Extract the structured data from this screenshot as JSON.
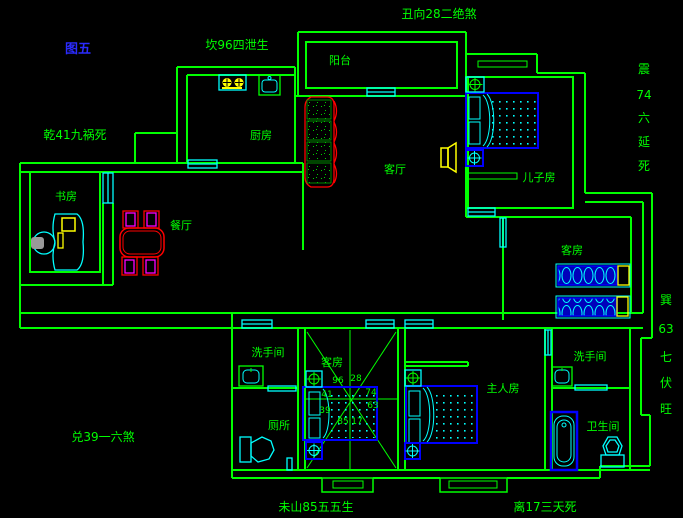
{
  "figure": {
    "tag": "图五"
  },
  "annotations": {
    "top": "丑向28二绝煞",
    "kan": "坎96四泄生",
    "qian": "乾41九祸死",
    "dui": "兑39一六煞",
    "wei": "未山85五五生",
    "li": "离17三天死",
    "zhen": [
      "震",
      "74",
      "六",
      "延",
      "死"
    ],
    "xun": [
      "巽",
      "63",
      "七",
      "伏",
      "旺"
    ]
  },
  "rooms": {
    "balcony": "阳台",
    "kitchen": "厨房",
    "study": "书房",
    "dining": "餐厅",
    "living": "客厅",
    "son": "儿子房",
    "guest_east": "客房",
    "guest_center": "客房",
    "wash_left": "洗手间",
    "toilet": "厕所",
    "master": "主人房",
    "wash_right": "洗手间",
    "bath": "卫生间"
  },
  "compass": {
    "n": "96",
    "ne": "28",
    "e": "74",
    "se": "63",
    "s": "17",
    "sw": "85",
    "w": "39",
    "nw": "41"
  },
  "colors": {
    "background": "#000000",
    "wall": "#00ff00",
    "window": "#00ffff",
    "bed": "#0000ff",
    "sofa_table": "#ff0000",
    "chair": "#ff00ff",
    "appliance": "#ffff00",
    "figure_text": "#2b2bff",
    "text": "#00ff00"
  }
}
